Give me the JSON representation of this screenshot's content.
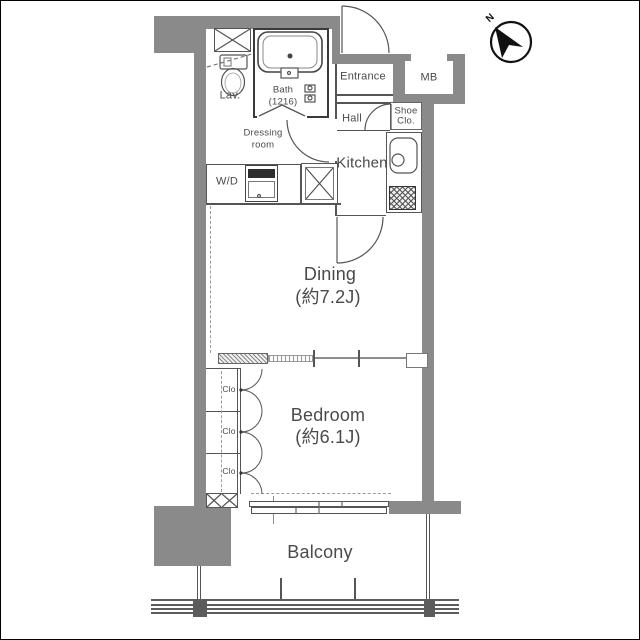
{
  "colors": {
    "wall": "#8a8a8a",
    "line": "#555555",
    "text": "#4a4a4a",
    "accent_dark": "#2e2e2e"
  },
  "compass": {
    "north_label": "N"
  },
  "labels": {
    "entrance": "Entrance",
    "meter_box": "MB",
    "shoe_closet": [
      "Shoe",
      "Clo."
    ],
    "hall": "Hall",
    "kitchen": "Kitchen",
    "lavatory": "Lav.",
    "bath": [
      "Bath",
      "(1216)"
    ],
    "dressing_room": [
      "Dressing",
      "room"
    ],
    "washer_dryer": "W/D",
    "dining": [
      "Dining",
      "(約7.2J)"
    ],
    "bedroom": [
      "Bedroom",
      "(約6.1J)"
    ],
    "closets": [
      "Clo",
      "Clo",
      "Clo"
    ],
    "balcony": "Balcony"
  }
}
